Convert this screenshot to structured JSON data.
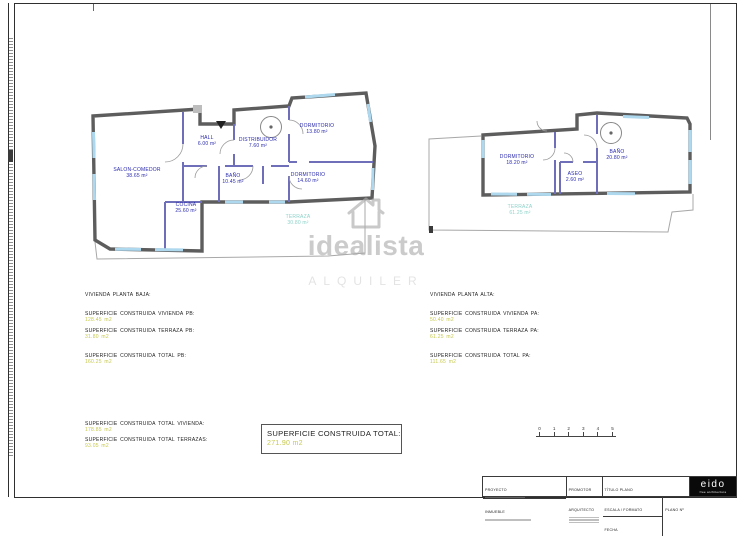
{
  "watermark": {
    "brand": "idealista",
    "stamp": "ALQUILER"
  },
  "plans": {
    "baja": {
      "rooms": [
        {
          "name": "SALON-COMEDOR",
          "area": "38.65 m²"
        },
        {
          "name": "HALL",
          "area": "6.00 m²"
        },
        {
          "name": "DISTRIBUIDOR",
          "area": "7.60 m²"
        },
        {
          "name": "DORMITORIO",
          "area": "13.80 m²"
        },
        {
          "name": "DORMITORIO",
          "area": "14.60 m²"
        },
        {
          "name": "BAÑO",
          "area": "10.45 m²"
        },
        {
          "name": "COCINA",
          "area": "25.60 m²"
        },
        {
          "name": "TERRAZA",
          "area": "30.80 m²"
        }
      ]
    },
    "alta": {
      "rooms": [
        {
          "name": "DORMITORIO",
          "area": "18.20 m²"
        },
        {
          "name": "BAÑO",
          "area": "20.80 m²"
        },
        {
          "name": "ASEO",
          "area": "2.60 m²"
        },
        {
          "name": "TERRAZA",
          "area": "61.25 m²"
        }
      ]
    }
  },
  "sections": {
    "baja": {
      "heading": "VIVIENDA PLANTA BAJA:",
      "lines": [
        {
          "label": "SUPERFICIE CONSTRUIDA VIVIENDA PB:",
          "value": "128.45 m2"
        },
        {
          "label": "SUPERFICIE CONSTRUIDA TERRAZA PB:",
          "value": "31.80 m2"
        },
        {
          "label": "SUPERFICIE CONSTRUIDA TOTAL PB:",
          "value": "160.25 m2"
        }
      ]
    },
    "alta": {
      "heading": "VIVIENDA PLANTA ALTA:",
      "lines": [
        {
          "label": "SUPERFICIE CONSTRUIDA VIVIENDA PA:",
          "value": "50.40 m2"
        },
        {
          "label": "SUPERFICIE CONSTRUIDA TERRAZA PA:",
          "value": "61.25 m2"
        },
        {
          "label": "SUPERFICIE CONSTRUIDA TOTAL PA:",
          "value": "111.65 m2"
        }
      ]
    },
    "totals": [
      {
        "label": "SUPERFICIE CONSTRUIDA TOTAL VIVIENDA:",
        "value": "178.85 m2"
      },
      {
        "label": "SUPERFICIE CONSTRUIDA TOTAL TERRAZAS:",
        "value": "93.05 m2"
      }
    ],
    "grand_total": {
      "label": "SUPERFICIE CONSTRUIDA TOTAL:",
      "value": "271.90 m2"
    }
  },
  "scalebar": {
    "ticks": [
      "0",
      "1",
      "2",
      "3",
      "4",
      "5"
    ]
  },
  "titleblock": {
    "proyecto": "PROYECTO",
    "inmueble": "INMUEBLE",
    "promotor": "PROMOTOR",
    "arquitecto": "ARQUITECTO",
    "titulo_plano": "TÍTULO PLANO",
    "escala": "ESCALA / FORMATO",
    "fecha": "FECHA",
    "plano_n": "PLANO Nº",
    "logo": "eido",
    "logo_sub": "free architecture"
  },
  "colors": {
    "wall": "#5d5d5d",
    "interior_wall": "#6f6fb9",
    "window": "#aed8ee",
    "room_label": "#2929ad",
    "terrace_label": "#8ed2c9",
    "area_value": "#c6c94e",
    "watermark": "#a9a9a9"
  }
}
